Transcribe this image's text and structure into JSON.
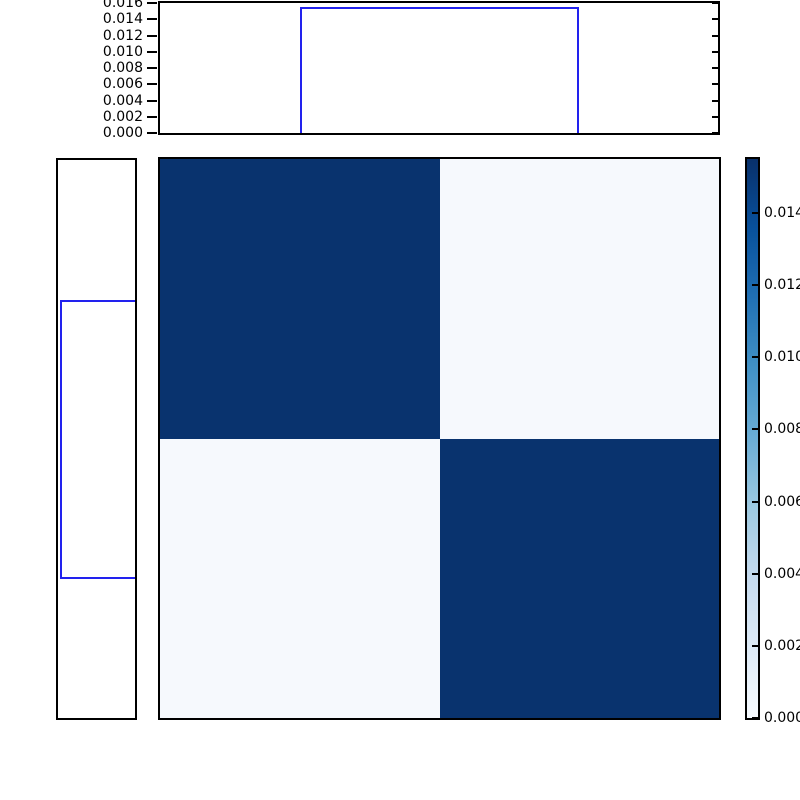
{
  "figure": {
    "kind": "joint-distribution-plot",
    "background": "#ffffff"
  },
  "colors": {
    "spine": "#000000",
    "tick_label": "#000000",
    "hist_line": "#2222ee",
    "heatmap_dark": "#09336e",
    "heatmap_light": "#f6f9fd",
    "colorbar_stops": [
      "#f7fbff",
      "#deebf7",
      "#c6dbef",
      "#9ecae1",
      "#6baed6",
      "#4292c6",
      "#2171b5",
      "#08519c",
      "#08306b"
    ]
  },
  "chart_data": {
    "type": "heatmap",
    "title": "",
    "description": "2x2 joint probability heatmap with marginal uniform step histograms and Blues colorbar",
    "heatmap": {
      "type": "heatmap",
      "matrix": [
        [
          0.0155,
          0.0003
        ],
        [
          0.0003,
          0.0155
        ]
      ],
      "colormap": "Blues",
      "vmin": 0.0,
      "vmax": 0.0155,
      "split_frac_x": 0.5,
      "split_frac_y": 0.5,
      "grid": false
    },
    "top_marginal": {
      "type": "line",
      "shape": "step-pulse",
      "pulse_start_frac": 0.25,
      "pulse_end_frac": 0.75,
      "pulse_height": 0.0155,
      "baseline": 0.0,
      "ylim": [
        0.0,
        0.016
      ],
      "yticks": [
        {
          "value": 0.016,
          "label": "0.016"
        },
        {
          "value": 0.014,
          "label": "0.014"
        },
        {
          "value": 0.012,
          "label": "0.012"
        },
        {
          "value": 0.01,
          "label": "0.010"
        },
        {
          "value": 0.008,
          "label": "0.008"
        },
        {
          "value": 0.006,
          "label": "0.006"
        },
        {
          "value": 0.004,
          "label": "0.004"
        },
        {
          "value": 0.002,
          "label": "0.002"
        },
        {
          "value": 0.0,
          "label": "0.000"
        }
      ]
    },
    "left_marginal": {
      "type": "line",
      "shape": "step-pulse",
      "pulse_start_frac": 0.25,
      "pulse_end_frac": 0.75,
      "pulse_height": 0.0155,
      "baseline": 0.0,
      "xlim": [
        0.0,
        0.016
      ],
      "tick_labels_shown": false
    },
    "colorbar": {
      "vmin": 0.0,
      "vmax": 0.0155,
      "ticks": [
        {
          "value": 0.014,
          "label": "0.014",
          "visible_text": "0.01"
        },
        {
          "value": 0.012,
          "label": "0.012",
          "visible_text": "0.01"
        },
        {
          "value": 0.01,
          "label": "0.010",
          "visible_text": "0.01"
        },
        {
          "value": 0.008,
          "label": "0.008",
          "visible_text": "0.00"
        },
        {
          "value": 0.006,
          "label": "0.006",
          "visible_text": "0.00"
        },
        {
          "value": 0.004,
          "label": "0.004",
          "visible_text": "0.00"
        },
        {
          "value": 0.002,
          "label": "0.002",
          "visible_text": "0.00"
        },
        {
          "value": 0.0,
          "label": "0.000",
          "visible_text": "0.00"
        }
      ],
      "legend_position": "right"
    }
  }
}
